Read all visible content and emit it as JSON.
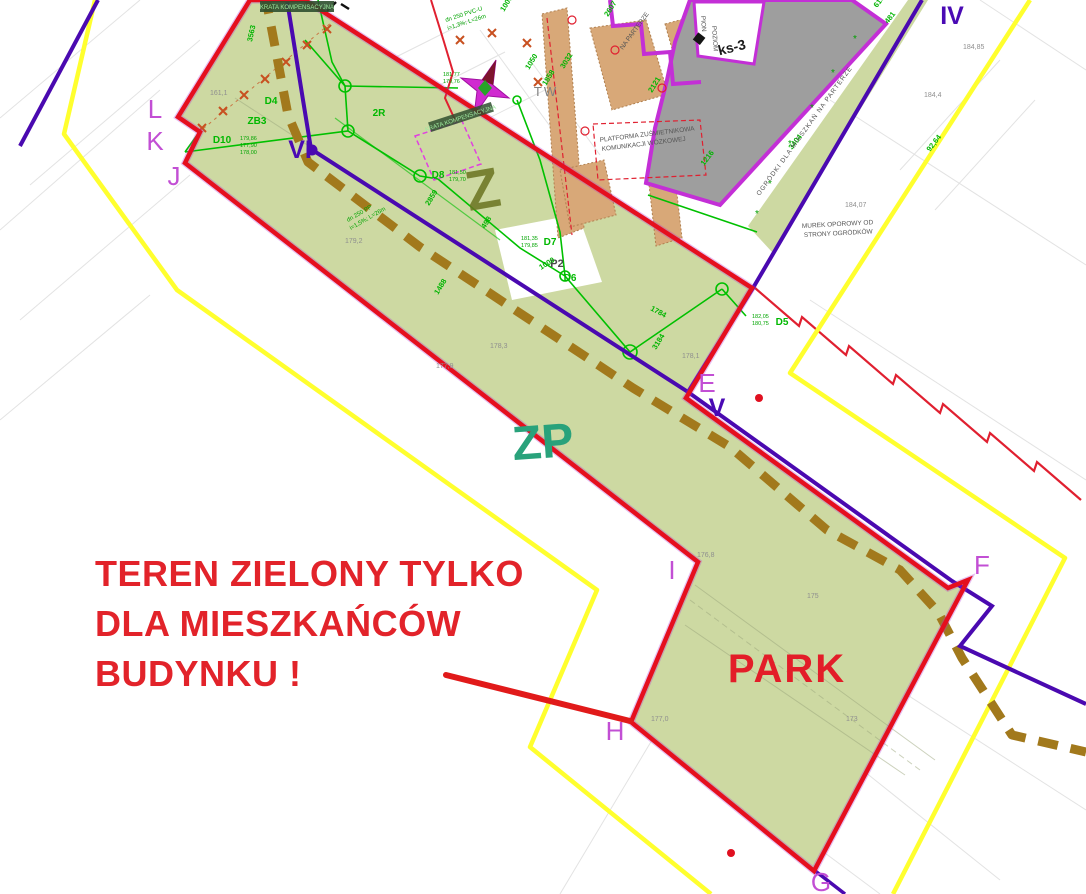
{
  "warning": {
    "line1": "TEREN ZIELONY TYLKO",
    "line2": "DLA MIESZKAŃCÓW",
    "line3": "BUDYNKU !"
  },
  "zones": {
    "z": "Z",
    "zp": "ZP",
    "park": "PARK"
  },
  "points": {
    "l": "L",
    "k": "K",
    "j": "J",
    "vi": "VI",
    "e": "E",
    "v": "V",
    "iv": "IV",
    "i": "I",
    "f": "F",
    "h": "H",
    "g": "G"
  },
  "annotations": {
    "tw": "TW",
    "p2": "P2",
    "r2": "2R",
    "ks3": "ks-3",
    "platforma_line1": "PLATFORMA ZUŚMIETNIKOWA",
    "platforma_line2": "KOMUNIKACJI WÓZKOWEJ",
    "murek_line1": "MUREK OPOROWY OD",
    "murek_line2": "STRONY OGRÓDKÓW",
    "ogrodki": "OGRÓDKI DLA MIESZKAŃ NA PARTERZE",
    "parterze": "NA PARTERZE",
    "pion": "PION",
    "poziom": "POZIOM",
    "krata": "KRATA KOMPENSACYJNA",
    "pipe1_line1": "dn 250 PVC-U",
    "pipe1_line2": "i=1,3%; L=26m",
    "pipe2_line1": "dn 250 PP",
    "pipe2_line2": "i=1,5%; L=26m"
  },
  "drains": {
    "d4": "D4",
    "zb3": "ZB3",
    "d10": "D10",
    "d8": "D8",
    "d7": "D7",
    "d6": "D6",
    "d5": "D5"
  },
  "levels": {
    "d10": [
      "179,86",
      "177,90",
      "178,00"
    ],
    "d8": [
      "181,50",
      "179,70"
    ],
    "d7": [
      "181,35",
      "179,85"
    ],
    "d5": [
      "182,05",
      "180,75"
    ],
    "star": [
      "181,77",
      "179,76"
    ]
  },
  "dimensions": [
    "3563",
    "2859",
    "498",
    "1488",
    "1050",
    "3032",
    "2607",
    "2121",
    "1858",
    "1000",
    "1784",
    "3184",
    "1216",
    "3404",
    "6100",
    "481",
    "92,64",
    "1000"
  ],
  "elevations": [
    "161,1",
    "179,2",
    "178,3",
    "177,9",
    "178,1",
    "176,8",
    "175",
    "177,0",
    "173",
    "184,85",
    "184,4",
    "184,07"
  ],
  "colors": {
    "boundary_red": "#e50f1e",
    "warning_text_red": "#e2232a",
    "parcel_yellow": "#ffff2e",
    "line_purple": "#4a09b0",
    "point_magenta": "#c24fd4",
    "building_outline_magenta": "#c32fd6",
    "green_area_fill": "#cdd9a2",
    "utility_green": "#00c000",
    "zp_teal": "#29a27b",
    "z_olive": "#6a7420",
    "path_brown": "#a2791c",
    "walkway_tan": "#d8a878",
    "building_gray": "#9e9e9e"
  }
}
